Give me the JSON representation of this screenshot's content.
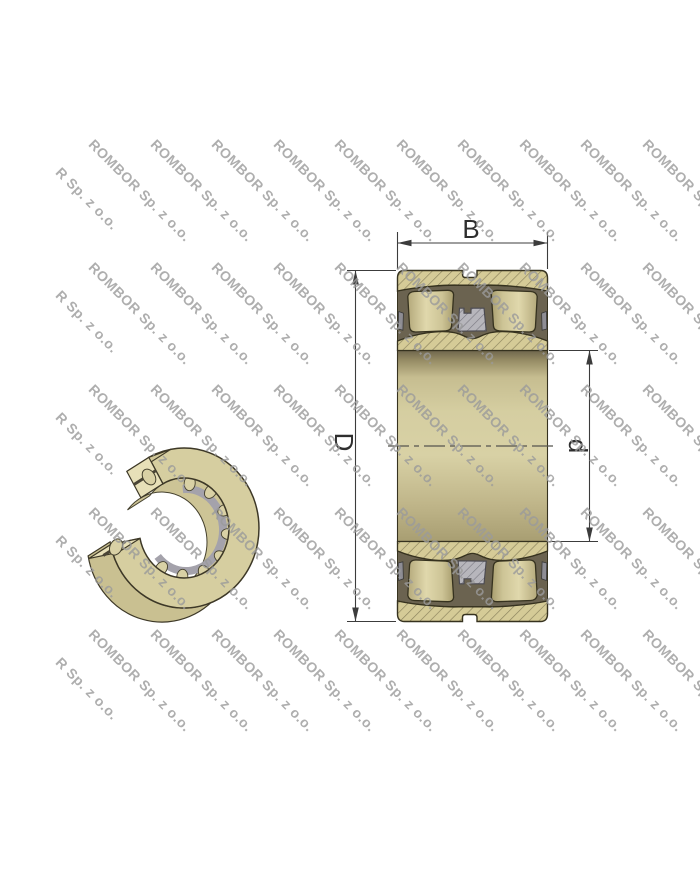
{
  "page": {
    "background": "#ffffff"
  },
  "watermark": {
    "text": "ROMBOR Sp. z o.o.",
    "color": "#9b9b9b",
    "opacity": 0.8,
    "angle_deg": 45,
    "grid": {
      "x_start": 97,
      "x_step": 61.5,
      "cols": 10,
      "y_start": 136,
      "y_step": 122.5,
      "rows": 5
    },
    "edge_column": {
      "text": "R Sp. z o.o.",
      "x": 63.5,
      "dy": 28
    }
  },
  "figure": {
    "left_view": {
      "name": "bearing-3d-cutaway-view"
    },
    "right_view": {
      "name": "bearing-cross-section-view"
    },
    "dimension_labels": {
      "width": "B",
      "outer_diameter": "D",
      "bore_diameter": "d"
    },
    "colors": {
      "ring_fill": "#d5cb97",
      "roller_fill": "#d9d1a5",
      "cavity": "#6b6350",
      "cage_gray": "#b3b2b8",
      "outline": "#36321f",
      "dimension_lines": "#3c3c3c",
      "bore_top_shadow": "#6f664d",
      "bore_mid": "#d8d1a5",
      "bore_bottom": "#a89e72"
    }
  }
}
